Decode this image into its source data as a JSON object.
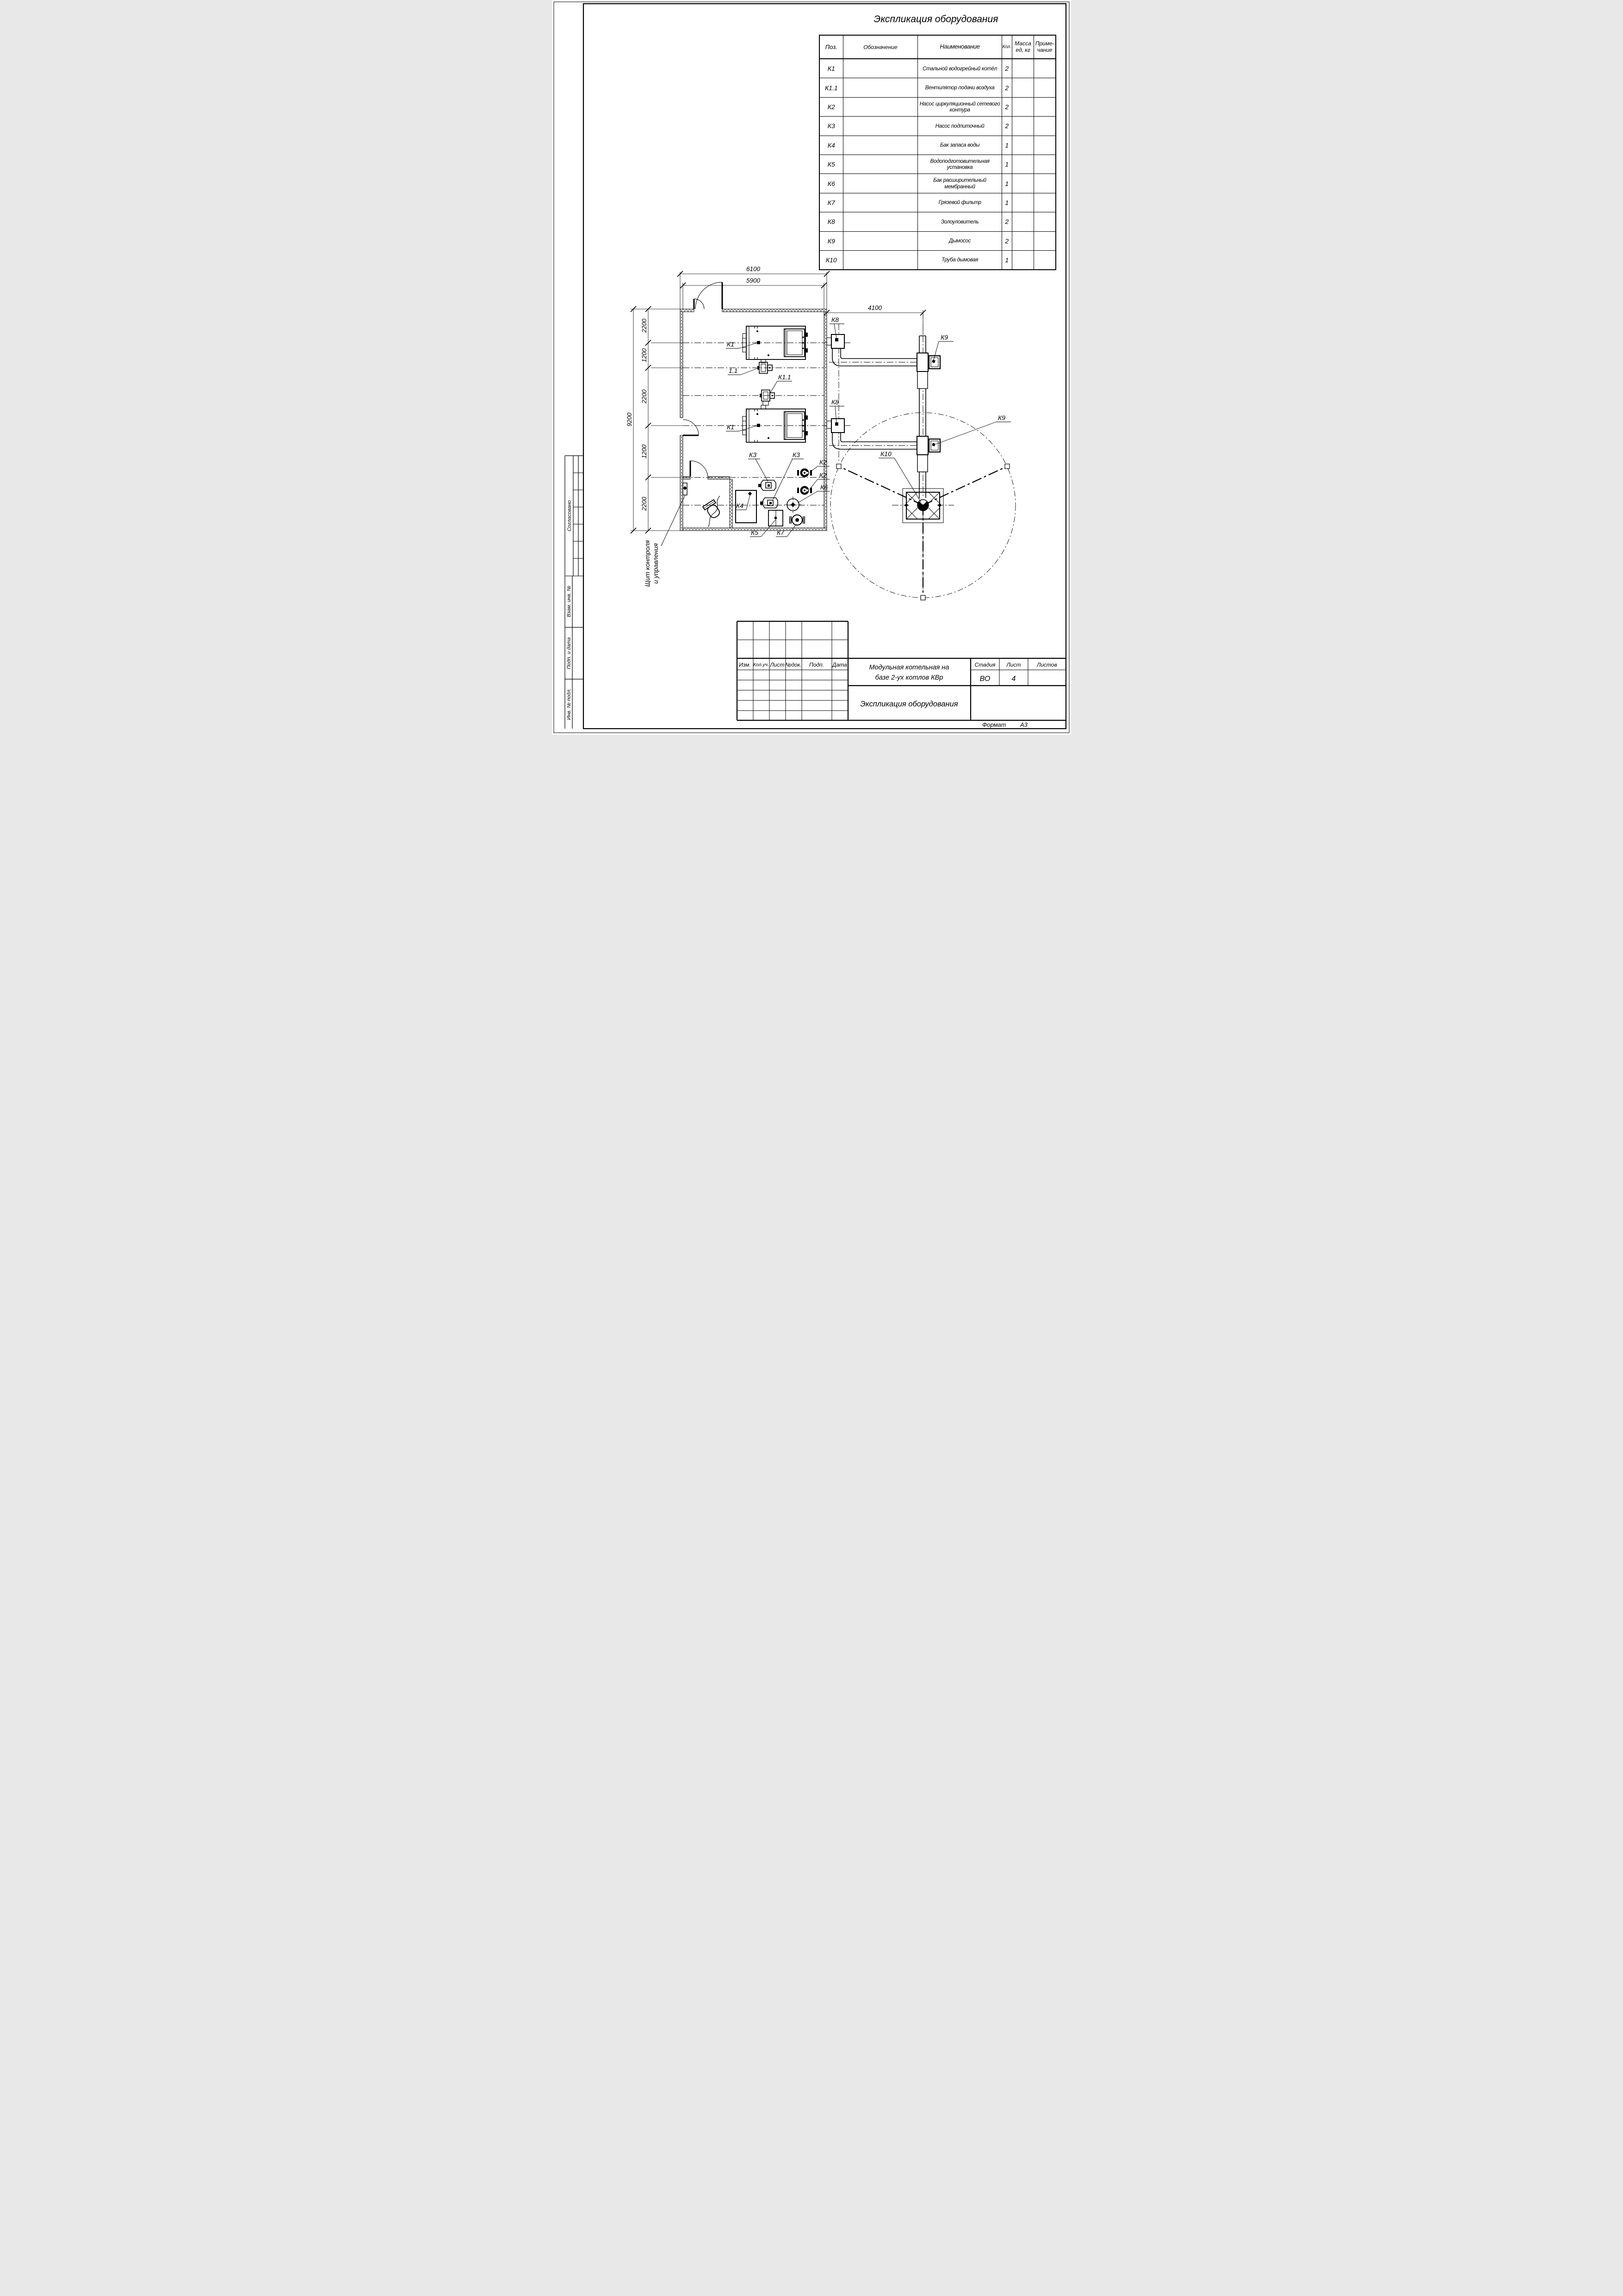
{
  "sheet": {
    "title": "Экспликация оборудования",
    "format_label": "Формат",
    "format_value": "А3"
  },
  "table": {
    "headers": {
      "pos": "Поз.",
      "designation": "Обозначение",
      "name": "Наименование",
      "qty": "Кол.",
      "mass1": "Масса",
      "mass2": "ед, кг",
      "note1": "Приме-",
      "note2": "чание"
    },
    "rows": [
      {
        "pos": "К1",
        "designation": "",
        "name": "Стальной водогрейный котёл",
        "qty": "2",
        "mass": "",
        "note": ""
      },
      {
        "pos": "К1.1",
        "designation": "",
        "name": "Вентилятор подачи воздуха",
        "qty": "2",
        "mass": "",
        "note": ""
      },
      {
        "pos": "К2",
        "designation": "",
        "name": "Насос циркуляционный сетевого контура",
        "qty": "2",
        "mass": "",
        "note": ""
      },
      {
        "pos": "К3",
        "designation": "",
        "name": "Насос подпиточный",
        "qty": "2",
        "mass": "",
        "note": ""
      },
      {
        "pos": "К4",
        "designation": "",
        "name": "Бак запаса воды",
        "qty": "1",
        "mass": "",
        "note": ""
      },
      {
        "pos": "К5",
        "designation": "",
        "name": "Водоподготовительная установка",
        "qty": "1",
        "mass": "",
        "note": ""
      },
      {
        "pos": "К6",
        "designation": "",
        "name": "Бак расширительный мембранный",
        "qty": "1",
        "mass": "",
        "note": ""
      },
      {
        "pos": "К7",
        "designation": "",
        "name": "Грязевой фильтр",
        "qty": "1",
        "mass": "",
        "note": ""
      },
      {
        "pos": "К8",
        "designation": "",
        "name": "Золоуловитель",
        "qty": "2",
        "mass": "",
        "note": ""
      },
      {
        "pos": "К9",
        "designation": "",
        "name": "Дымосос",
        "qty": "2",
        "mass": "",
        "note": ""
      },
      {
        "pos": "К10",
        "designation": "",
        "name": "Труба дымовая",
        "qty": "1",
        "mass": "",
        "note": ""
      }
    ]
  },
  "dims": {
    "top_outer": "6100",
    "top_inner": "5900",
    "right": "4100",
    "left_total": "9200",
    "seg1": "2200",
    "seg2": "1200",
    "seg3": "2200",
    "seg4": "1200",
    "seg5": "2200"
  },
  "plan": {
    "labels": {
      "k1a": "К1",
      "k1b": "К1",
      "f11": "1.1",
      "k11": "К1.1",
      "k8a": "К8",
      "k8b": "К8",
      "k9a": "К9",
      "k9b": "К9",
      "k2a": "К2",
      "k2b": "К2",
      "k3a": "К3",
      "k3b": "К3",
      "k4": "К4",
      "k5": "К5",
      "k6": "К6",
      "k7": "К7",
      "k10": "К10",
      "panel_line1": "Щит контроля",
      "panel_line2": "и управления"
    }
  },
  "sidebar": {
    "agreed": "Согласовано",
    "vzam": "Взам. инв. №",
    "podp": "Подп. и дата",
    "inv": "Инв. № подл."
  },
  "titleblock": {
    "cols": {
      "izm": "Изм.",
      "koluch": "Кол.уч.",
      "list": "Лист",
      "ndok": "№док.",
      "podp": "Подп.",
      "data": "Дата"
    },
    "object_line1": "Модульная котельная на",
    "object_line2": "базе 2-ух котлов КВр",
    "doc_name": "Экспликация оборудования",
    "stage_label": "Стадия",
    "stage_value": "ВО",
    "sheet_label": "Лист",
    "sheet_value": "4",
    "sheets_label": "Листов",
    "sheets_value": ""
  }
}
